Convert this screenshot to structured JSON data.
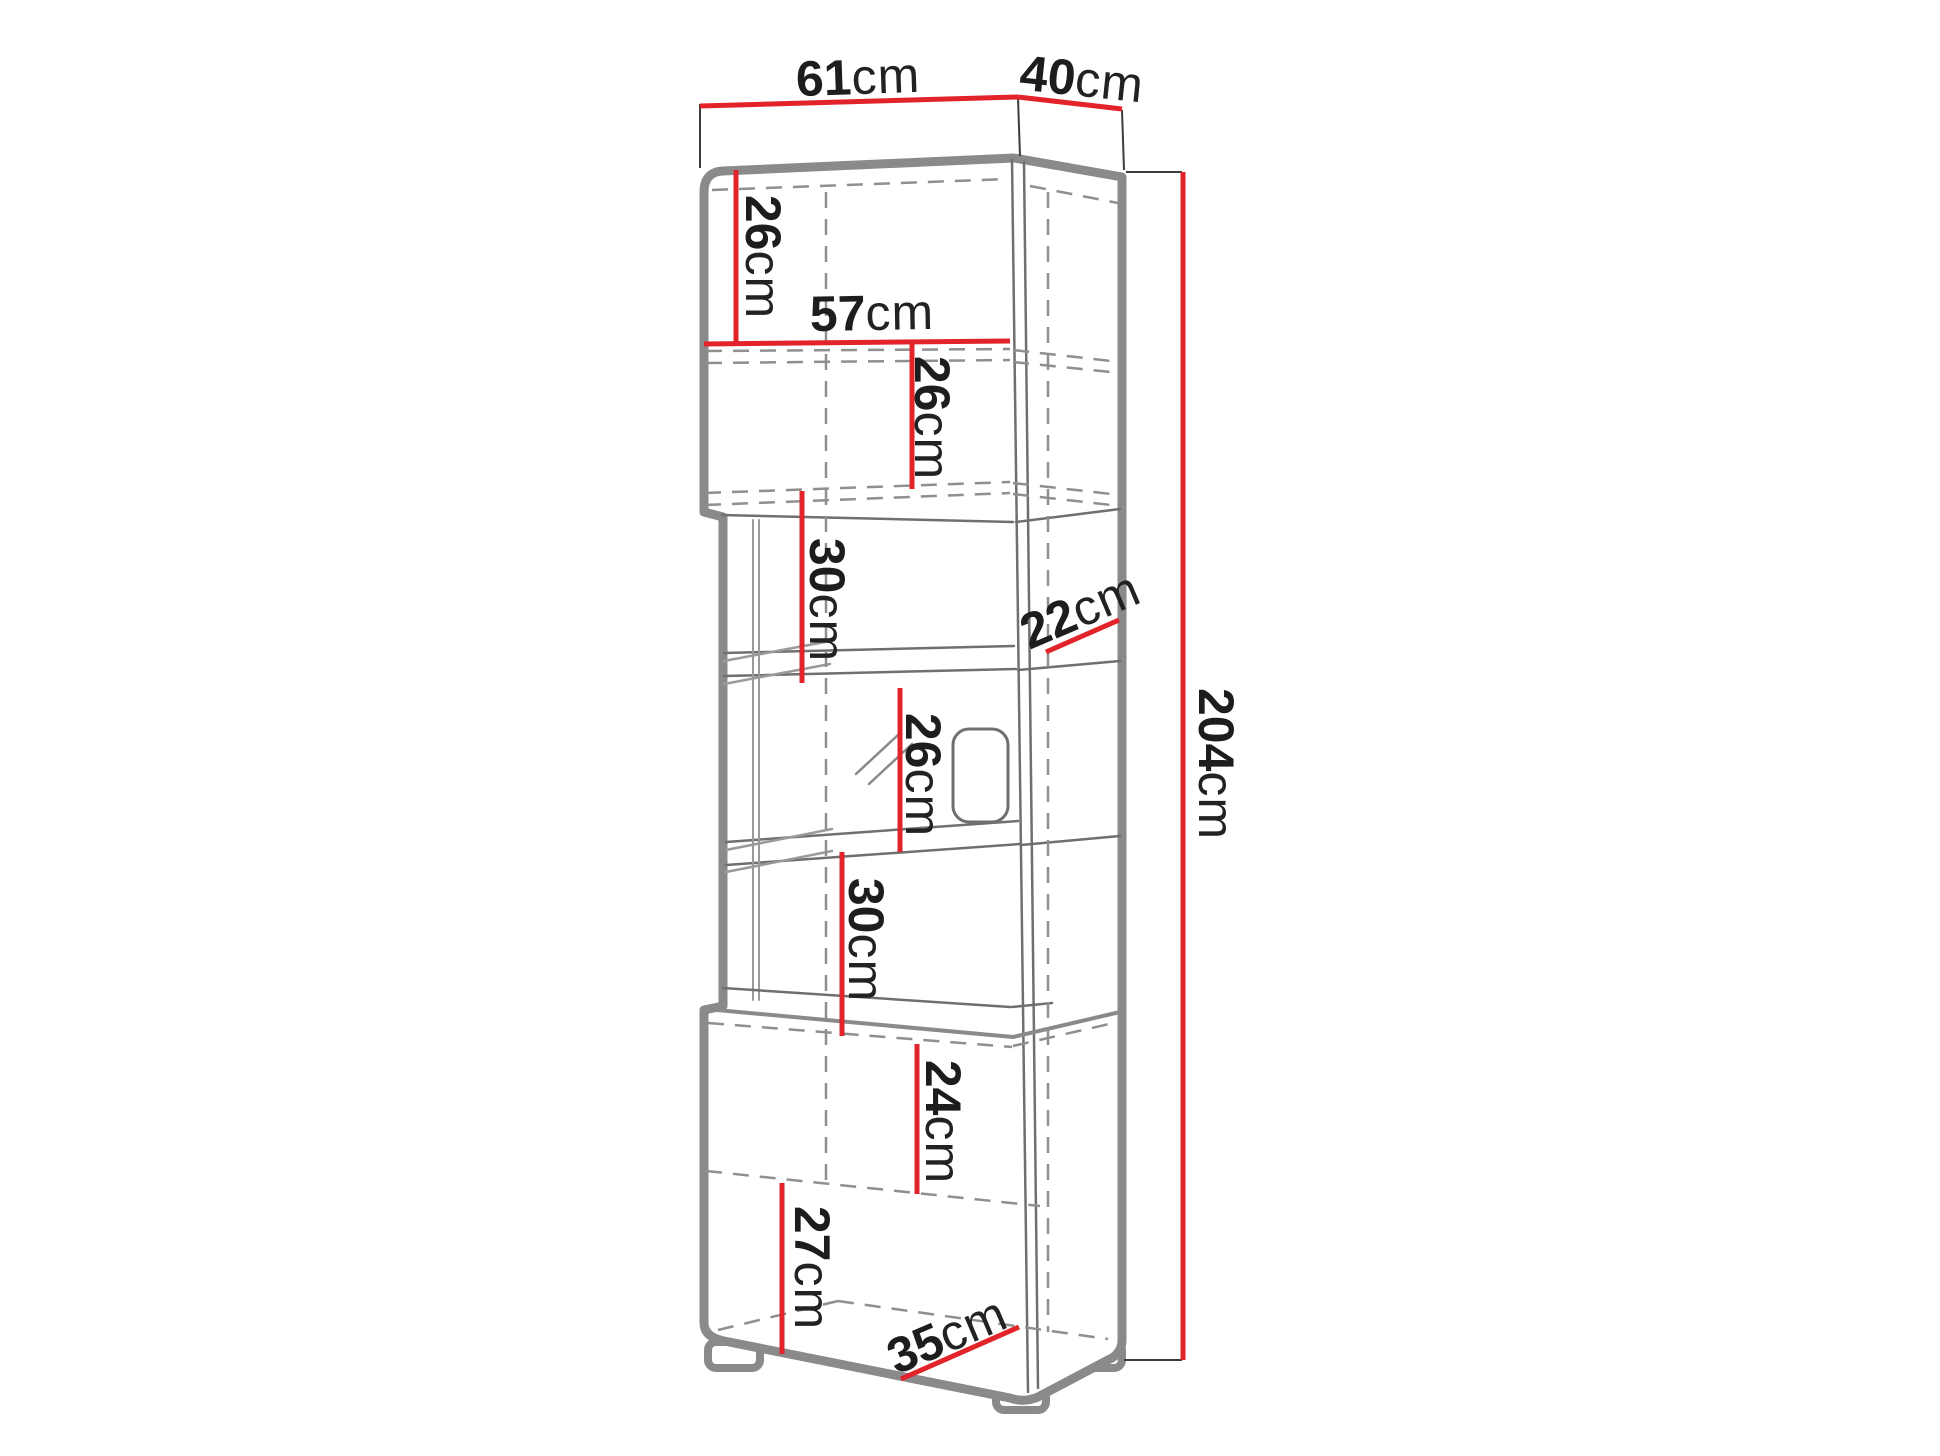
{
  "diagram": {
    "kind": "furniture-dimension-drawing",
    "unit": "cm",
    "colors": {
      "dimension_line": "#e2232a",
      "outline_gray": "#8a8a8a",
      "inner_line_gray": "#6f6f6f",
      "dashed_gray": "#8f8f8f",
      "text": "#1d1d1d",
      "background": "#ffffff"
    },
    "dimensions": {
      "top_width": {
        "value": "61",
        "unit": "cm"
      },
      "top_depth": {
        "value": "40",
        "unit": "cm"
      },
      "upper_section_height": {
        "value": "26",
        "unit": "cm"
      },
      "upper_inner_width": {
        "value": "57",
        "unit": "cm"
      },
      "upper_shelf_height": {
        "value": "26",
        "unit": "cm"
      },
      "middle_upper_height": {
        "value": "30",
        "unit": "cm"
      },
      "middle_depth": {
        "value": "22",
        "unit": "cm"
      },
      "middle_glass_height": {
        "value": "26",
        "unit": "cm"
      },
      "middle_lower_height": {
        "value": "30",
        "unit": "cm"
      },
      "base_upper_height": {
        "value": "24",
        "unit": "cm"
      },
      "base_lower_height": {
        "value": "27",
        "unit": "cm"
      },
      "base_depth": {
        "value": "35",
        "unit": "cm"
      },
      "total_height": {
        "value": "204",
        "unit": "cm"
      }
    }
  }
}
